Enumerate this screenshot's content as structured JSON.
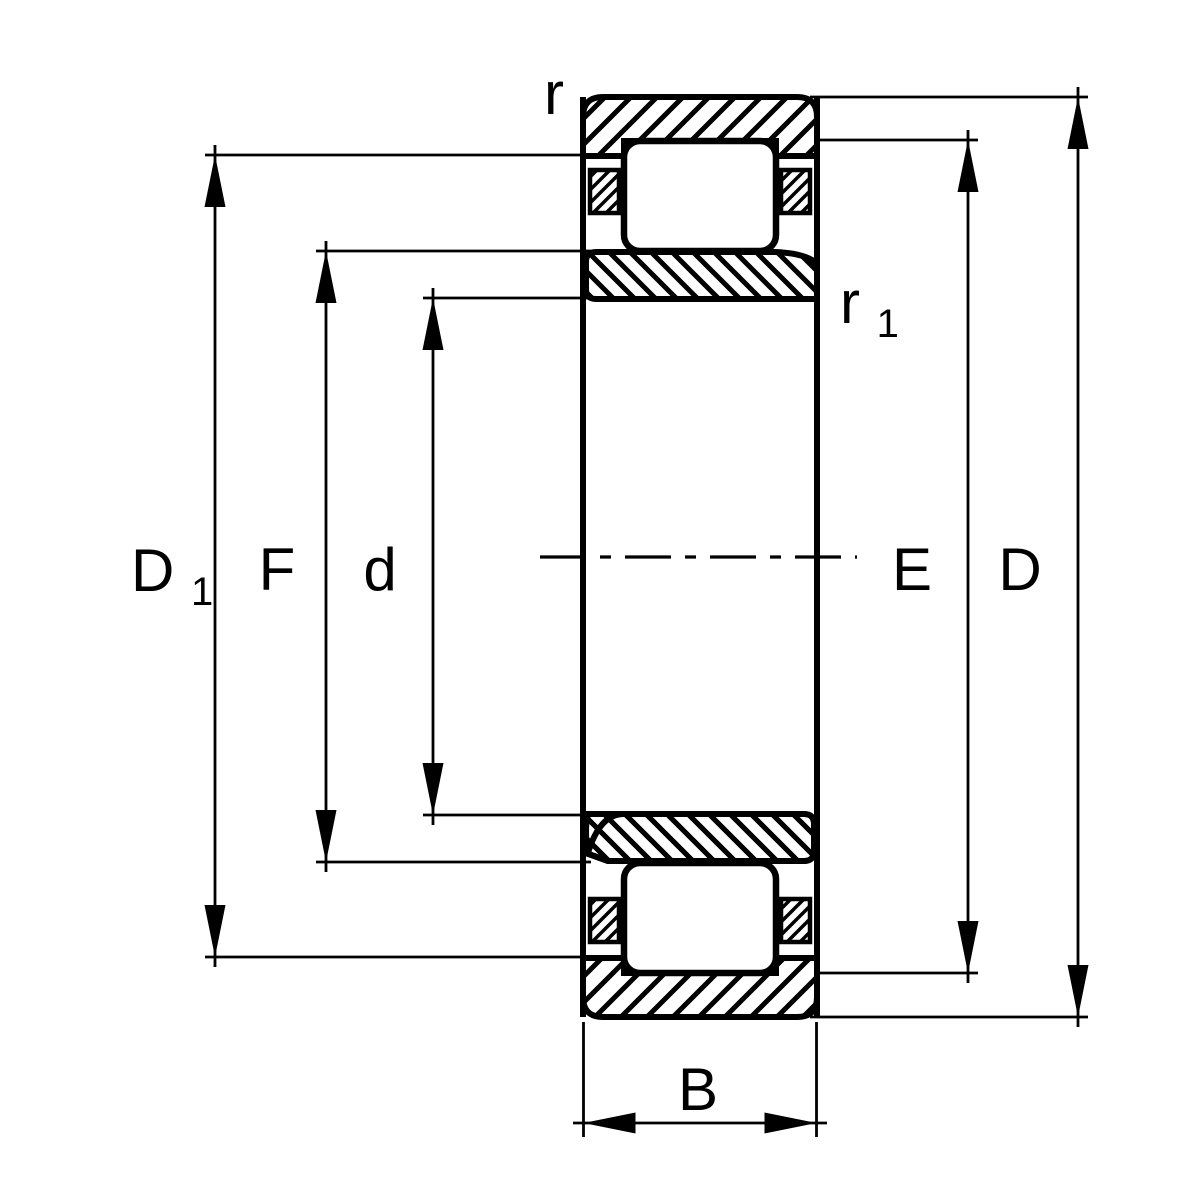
{
  "drawing": {
    "background_color": "#ffffff",
    "line_color": "#000000",
    "labels": {
      "corner_radius": {
        "main": "r",
        "sub": ""
      },
      "inner_corner_radius": {
        "main": "r",
        "sub": "1"
      },
      "shoulder_diameter": {
        "main": "D",
        "sub": "1"
      },
      "inner_raceway_diameter": {
        "main": "F",
        "sub": ""
      },
      "bore_diameter": {
        "main": "d",
        "sub": ""
      },
      "outer_raceway_diameter": {
        "main": "E",
        "sub": ""
      },
      "outside_diameter": {
        "main": "D",
        "sub": ""
      },
      "width": {
        "main": "B",
        "sub": ""
      }
    }
  }
}
